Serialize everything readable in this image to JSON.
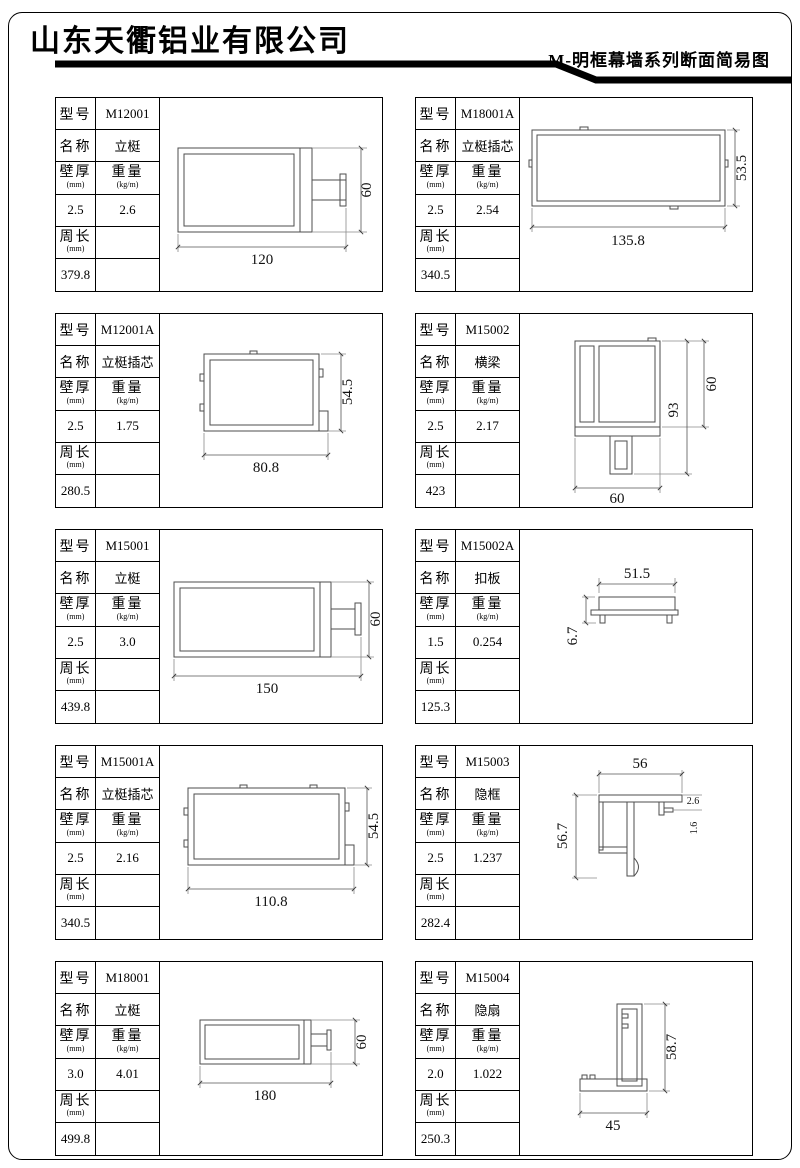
{
  "header": {
    "company": "山东天衢铝业有限公司",
    "subtitle": "M-明框幕墙系列断面简易图"
  },
  "labels": {
    "model": "型号",
    "name": "名称",
    "wall": "壁厚",
    "wall_unit": "(mm)",
    "weight": "重量",
    "weight_unit": "(kg/m)",
    "perimeter": "周长",
    "perimeter_unit": "(mm)"
  },
  "cells": [
    {
      "model": "M12001",
      "name": "立梃",
      "wall": "2.5",
      "weight": "2.6",
      "perimeter": "379.8",
      "dims": {
        "w": "120",
        "h": "60"
      }
    },
    {
      "model": "M18001A",
      "name": "立梃插芯",
      "wall": "2.5",
      "weight": "2.54",
      "perimeter": "340.5",
      "dims": {
        "w": "135.8",
        "h": "53.5"
      }
    },
    {
      "model": "M12001A",
      "name": "立梃插芯",
      "wall": "2.5",
      "weight": "1.75",
      "perimeter": "280.5",
      "dims": {
        "w": "80.8",
        "h": "54.5"
      }
    },
    {
      "model": "M15002",
      "name": "横梁",
      "wall": "2.5",
      "weight": "2.17",
      "perimeter": "423",
      "dims": {
        "w": "60",
        "h_total": "93",
        "h_upper": "60"
      }
    },
    {
      "model": "M15001",
      "name": "立梃",
      "wall": "2.5",
      "weight": "3.0",
      "perimeter": "439.8",
      "dims": {
        "w": "150",
        "h": "60"
      }
    },
    {
      "model": "M15002A",
      "name": "扣板",
      "wall": "1.5",
      "weight": "0.254",
      "perimeter": "125.3",
      "dims": {
        "w": "51.5",
        "h": "6.7"
      }
    },
    {
      "model": "M15001A",
      "name": "立梃插芯",
      "wall": "2.5",
      "weight": "2.16",
      "perimeter": "340.5",
      "dims": {
        "w": "110.8",
        "h": "54.5"
      }
    },
    {
      "model": "M15003",
      "name": "隐框",
      "wall": "2.5",
      "weight": "1.237",
      "perimeter": "282.4",
      "dims": {
        "w": "56",
        "h": "56.7",
        "d1": "2.6",
        "d2": "1.6"
      }
    },
    {
      "model": "M18001",
      "name": "立梃",
      "wall": "3.0",
      "weight": "4.01",
      "perimeter": "499.8",
      "dims": {
        "w": "180",
        "h": "60"
      }
    },
    {
      "model": "M15004",
      "name": "隐扇",
      "wall": "2.0",
      "weight": "1.022",
      "perimeter": "250.3",
      "dims": {
        "w": "45",
        "h": "58.7"
      }
    }
  ]
}
